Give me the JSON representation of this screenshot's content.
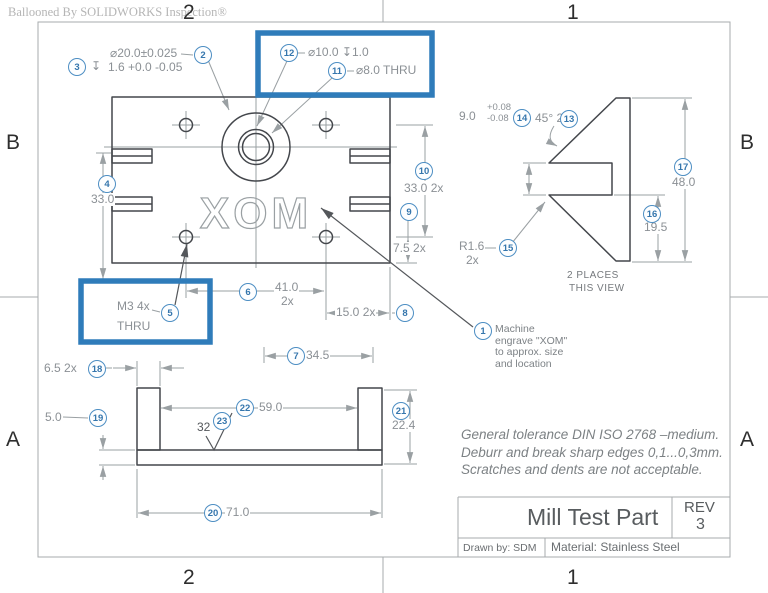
{
  "watermark": "Ballooned By SOLIDWORKS Inspection®",
  "zones": {
    "top_left": "2",
    "top_right": "1",
    "bottom_left": "2",
    "bottom_right": "1",
    "left_upper": "B",
    "left_lower": "A",
    "right_upper": "B",
    "right_lower": "A"
  },
  "balloons": {
    "b1": "1",
    "b2": "2",
    "b3": "3",
    "b4": "4",
    "b5": "5",
    "b6": "6",
    "b7": "7",
    "b8": "8",
    "b9": "9",
    "b10": "10",
    "b11": "11",
    "b12": "12",
    "b13": "13",
    "b14": "14",
    "b15": "15",
    "b16": "16",
    "b17": "17",
    "b18": "18",
    "b19": "19",
    "b20": "20",
    "b21": "21",
    "b22": "22",
    "b23": "23"
  },
  "labels": {
    "depth_symbol": "↧",
    "dim2": "⌀20.0±0.025",
    "dim3": "1.6 +0.0 -0.05",
    "dim12": "⌀10.0 ↧1.0",
    "dim11": "⌀8.0 THRU",
    "dim4": "33.0",
    "dim10": "33.0 2x",
    "dim9": "7.5 2x",
    "dim5_line1": "M3 4x",
    "dim5_line2": "THRU",
    "dim6_value": "41.0",
    "dim6_qty": "2x",
    "dim8": "15.0 2x",
    "dim7": "34.5",
    "dim14_value": "9.0",
    "dim14_plus": "+0.08",
    "dim14_minus": "-0.08",
    "dim13": "45° 2x",
    "dim17": "48.0",
    "dim16": "19.5",
    "dim15_line1": "R1.6",
    "dim15_line2": "2x",
    "dim18": "6.5 2x",
    "dim19": "5.0",
    "dim22": "59.0",
    "dim23": "32",
    "dim21": "22.4",
    "dim20": "71.0",
    "engraving": "XOM",
    "places_line1": "2 PLACES",
    "places_line2": "THIS VIEW"
  },
  "note_engrave": {
    "line1": "Machine",
    "line2": "engrave \"XOM\"",
    "line3": "to approx. size",
    "line4": "and location"
  },
  "general_notes": [
    "General tolerance DIN ISO 2768 –medium.",
    "Deburr and break sharp edges 0,1...0,3mm.",
    "Scratches and dents are not acceptable."
  ],
  "title_block": {
    "title": "Mill Test Part",
    "rev_label": "REV",
    "rev_value": "3",
    "drawn_by": "Drawn by: SDM",
    "material": "Material: Stainless Steel"
  },
  "colors": {
    "balloon_blue": "#4d8ec3",
    "highlight_blue": "#2f7cba",
    "part_line": "#44474c",
    "dim_line": "#9aa0a3"
  }
}
